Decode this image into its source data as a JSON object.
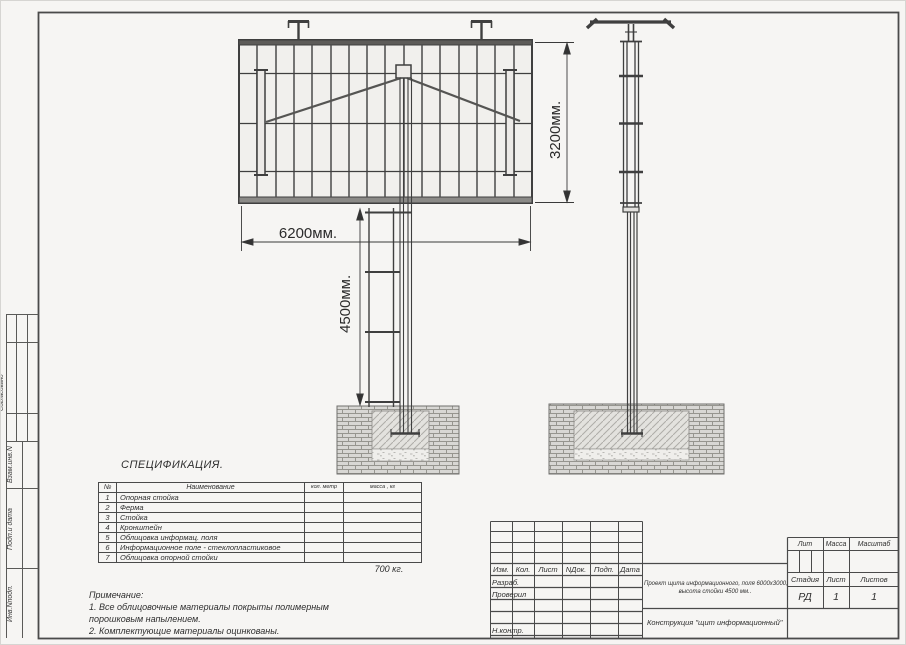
{
  "colors": {
    "line": "#4a4a4a",
    "background": "#f6f5f3",
    "text": "#2f2f2f"
  },
  "dimensions": {
    "panel_width": "6200мм.",
    "stand_height": "4500мм.",
    "panel_height": "3200мм."
  },
  "margin_labels": {
    "soglasovano": "Согласовано",
    "vzam_inv": "Взам.инв.N",
    "podp_data": "Подп.и дата",
    "inv_podl": "Инв.Nподп."
  },
  "specification": {
    "title": "СПЕЦИФИКАЦИЯ.",
    "headers": {
      "no": "№",
      "name": "Наименование",
      "qty": "кол. метр",
      "mass": "масса , кг"
    },
    "rows": [
      {
        "no": "1",
        "name": "Опорная стойка",
        "qty": "",
        "mass": ""
      },
      {
        "no": "2",
        "name": "Ферма",
        "qty": "",
        "mass": ""
      },
      {
        "no": "3",
        "name": "Стойка",
        "qty": "",
        "mass": ""
      },
      {
        "no": "4",
        "name": "Кронштейн",
        "qty": "",
        "mass": ""
      },
      {
        "no": "5",
        "name": "Облицовка информац. поля",
        "qty": "",
        "mass": ""
      },
      {
        "no": "6",
        "name": "Информационное поле - стеклопластиковое",
        "qty": "",
        "mass": ""
      },
      {
        "no": "7",
        "name": "Облицовка опорной стойки",
        "qty": "",
        "mass": ""
      }
    ],
    "total": "700 кг."
  },
  "notes": {
    "title": "Примечание:",
    "line1": "1. Все облицовочные материалы покрыты полимерным",
    "line2": "порошковым напылением.",
    "line3": "2. Комплектующие материалы оцинкованы."
  },
  "title_block": {
    "col_izm": "Изм.",
    "col_kol": "Кол.",
    "col_list": "Лист",
    "col_ndok": "NДок.",
    "col_podp": "Подп.",
    "col_data": "Дата",
    "row_razrab": "Разраб.",
    "row_proveril": "Проверил",
    "row_nkontr": "Н.контр.",
    "description_line1": "Проект щита информационного, поля 6000х3000,",
    "description_line2": "высота стойки 4500 мм..",
    "construction": "Конструкция \"щит информационный\"",
    "lit": "Лит",
    "massa": "Масса",
    "masshtab": "Масштаб",
    "stadia": "Стадия",
    "list": "Лист",
    "listov": "Листов",
    "stadia_value": "РД",
    "list_value": "1",
    "listov_value": "1"
  }
}
